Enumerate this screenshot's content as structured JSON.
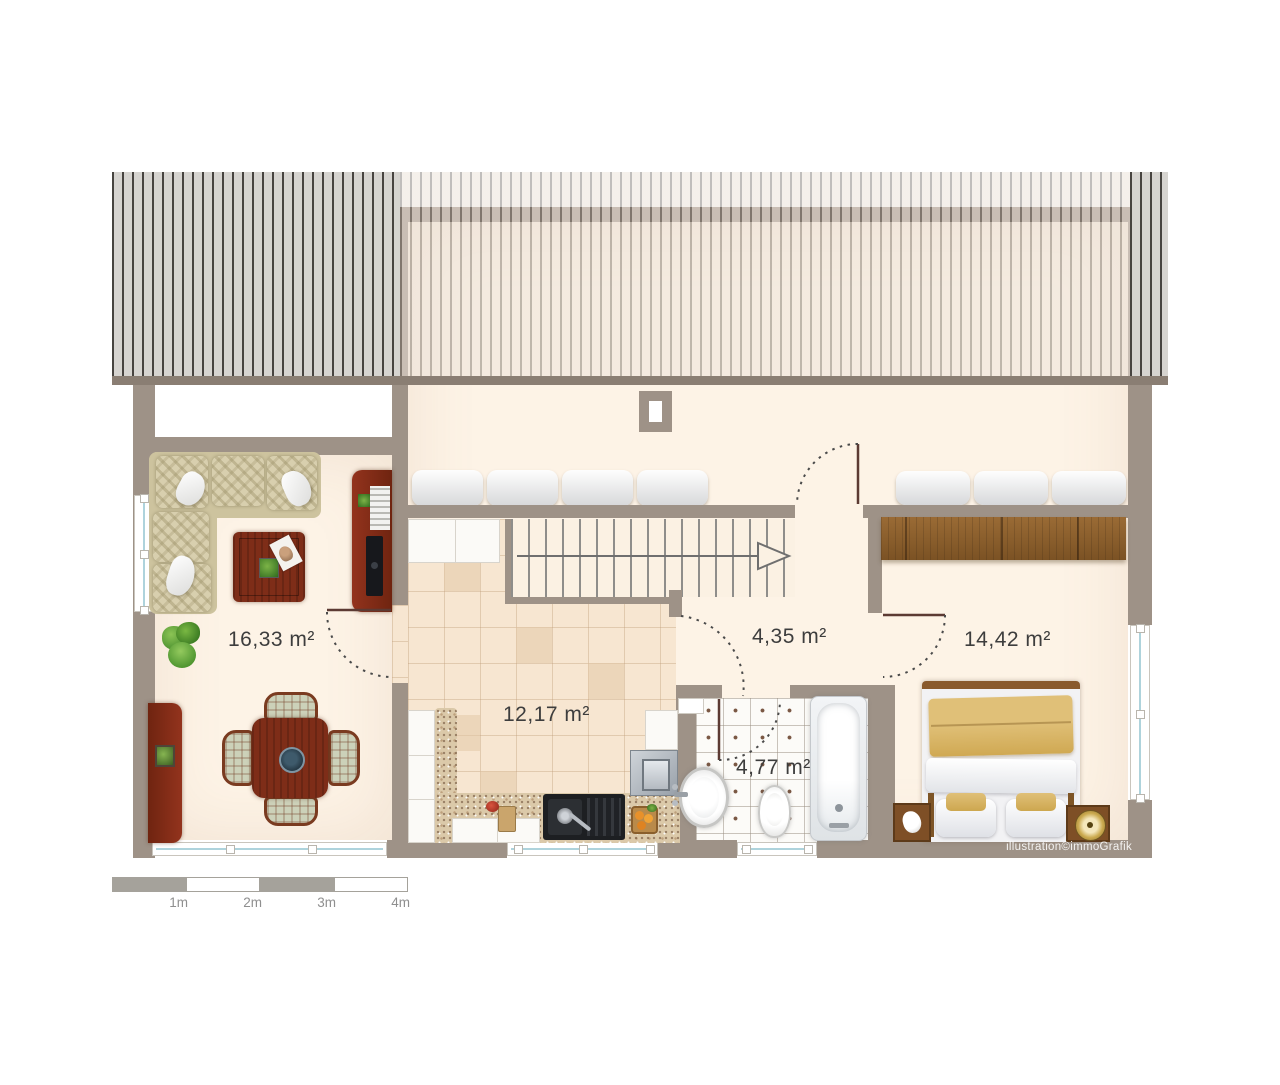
{
  "plan": {
    "type": "floor-plan-illustration",
    "rooms": [
      {
        "name": "living-dining-room",
        "area_label": "16,33 m²"
      },
      {
        "name": "kitchen",
        "area_label": "12,17 m²"
      },
      {
        "name": "hallway",
        "area_label": "4,35 m²"
      },
      {
        "name": "bathroom",
        "area_label": "4,77 m²"
      },
      {
        "name": "bedroom",
        "area_label": "14,42 m²"
      }
    ],
    "scale_bar": {
      "labels": [
        "1m",
        "2m",
        "3m",
        "4m"
      ]
    },
    "credit": "illustration©immoGrafik",
    "colors": {
      "wall": "#9e9287",
      "floor": "#fdf3e6",
      "roof_stripe_dark": "#474440",
      "roof_stripe_light": "#d6d4d0",
      "kitchen_tile": "#f7e6d1",
      "wood_accent": "#7e2d18",
      "window_glass": "#aed3dc",
      "label_text": "#3d3d3d"
    }
  }
}
